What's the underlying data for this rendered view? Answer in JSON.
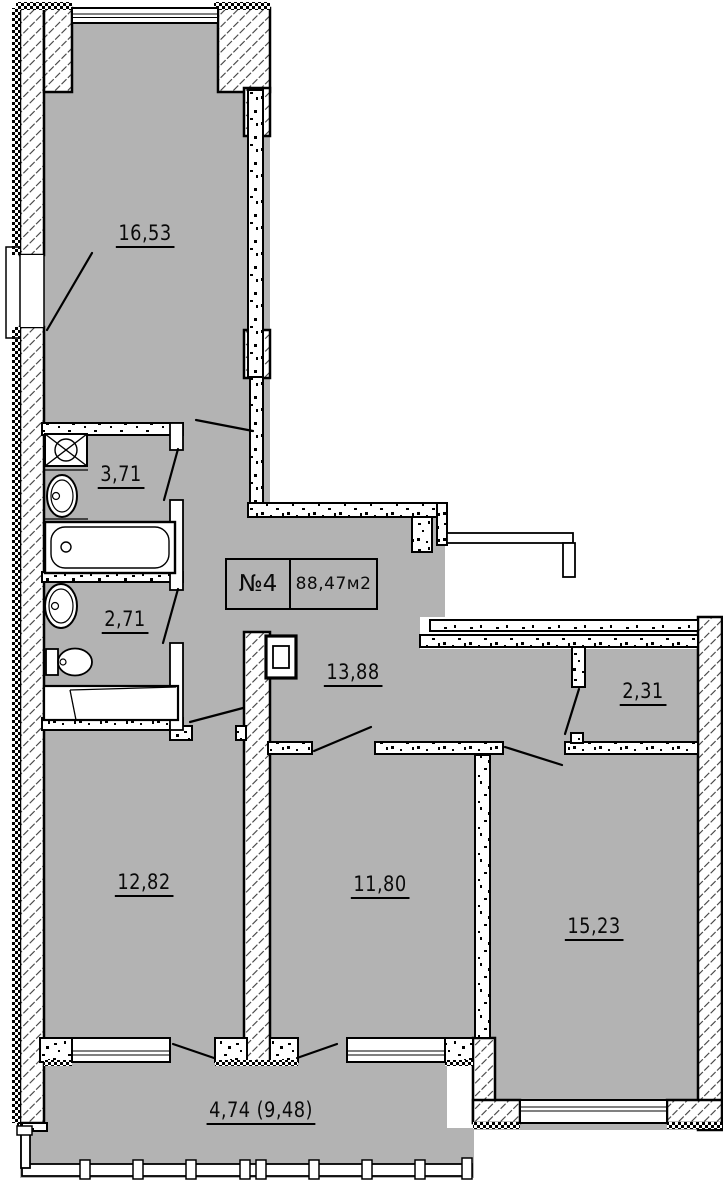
{
  "plan": {
    "unit_label": "№4",
    "total_area": "88,47м2",
    "rooms": [
      {
        "id": "room-16-53",
        "area": "16,53"
      },
      {
        "id": "bath-3-71",
        "area": "3,71"
      },
      {
        "id": "bath-2-71",
        "area": "2,71"
      },
      {
        "id": "hall-13-88",
        "area": "13,88"
      },
      {
        "id": "entry-2-31",
        "area": "2,31"
      },
      {
        "id": "room-12-82",
        "area": "12,82"
      },
      {
        "id": "room-11-80",
        "area": "11,80"
      },
      {
        "id": "room-15-23",
        "area": "15,23"
      },
      {
        "id": "balcony-4-74",
        "area": "4,74 (9,48)"
      }
    ],
    "colors": {
      "floor": "#b3b3b3",
      "line": "#000000",
      "wall_fill": "#ffffff"
    }
  }
}
